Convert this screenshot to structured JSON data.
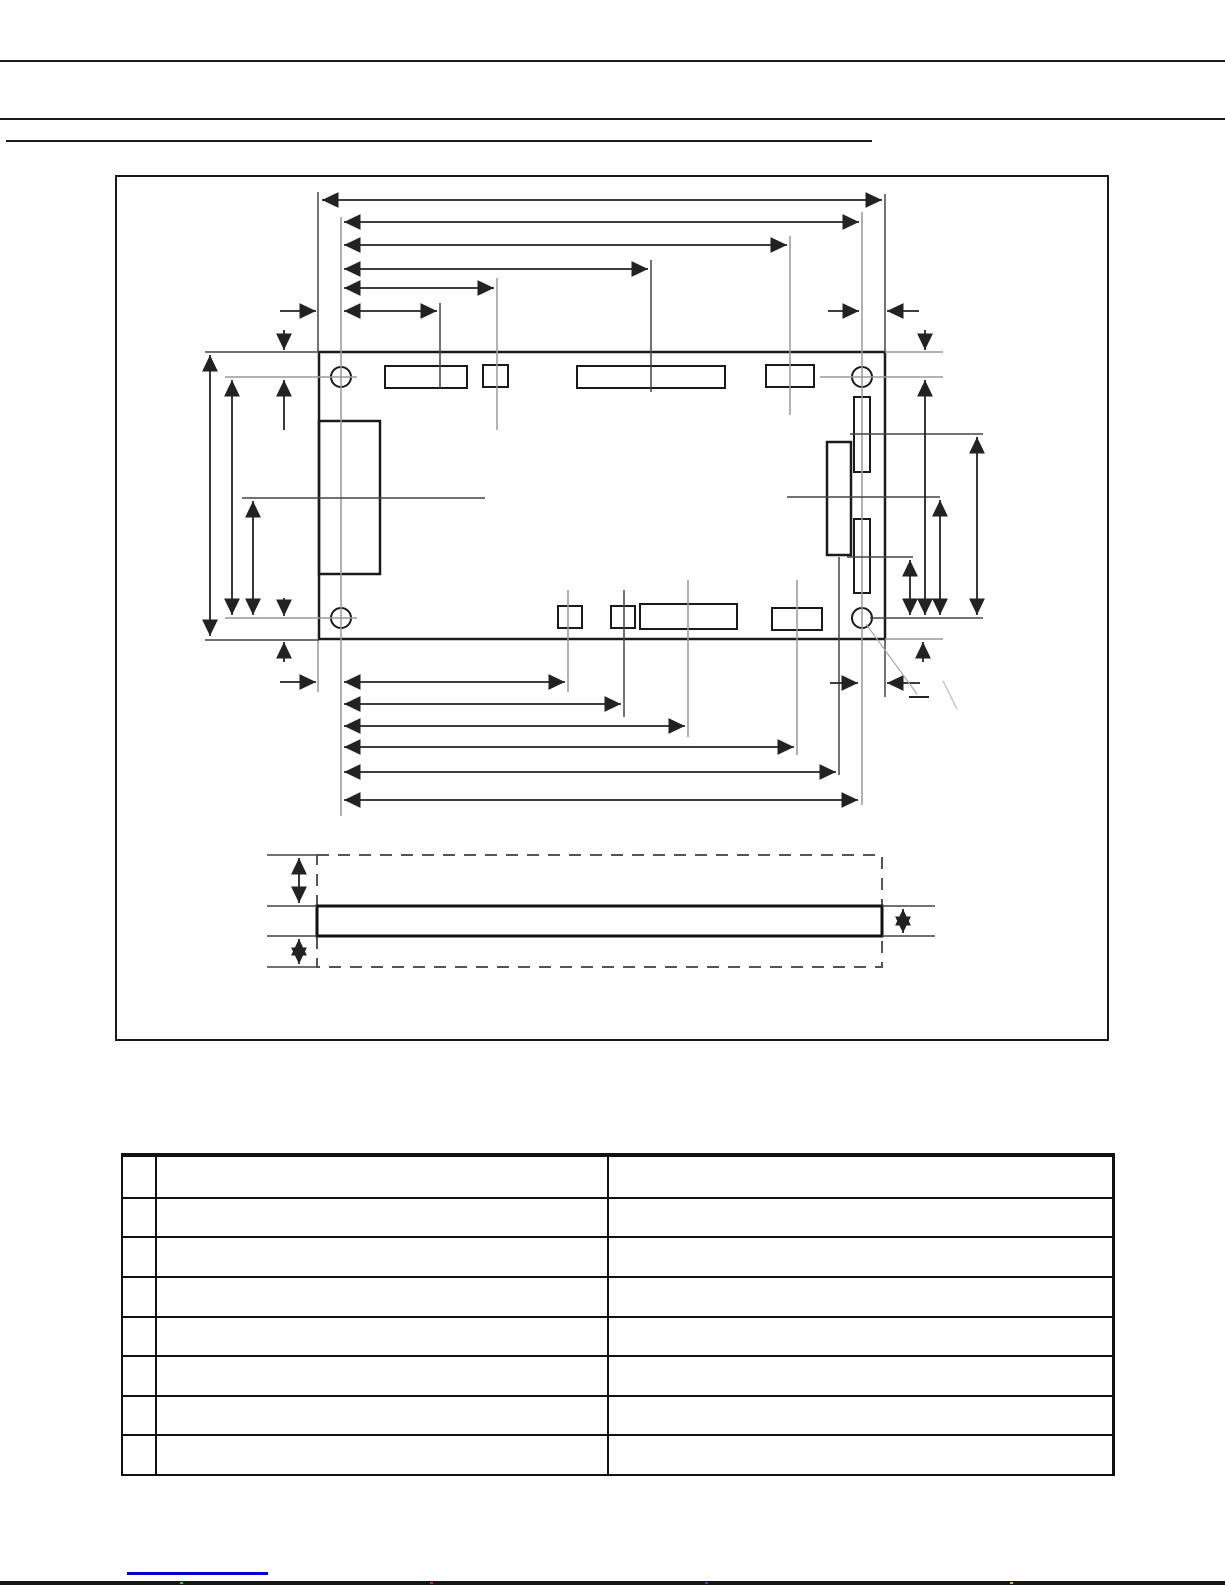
{
  "page": {
    "background": "#ffffff",
    "kind": "datasheet mechanical drawing page (all text redacted / not visible)"
  },
  "header": {
    "rule_color": "#1a1a1a",
    "rules": 3
  },
  "figure": {
    "border_color": "#1a1a1a",
    "parts": {
      "board_outline": "pcb-top-view-outline",
      "mounting_holes": 4,
      "top_edge_connectors": 4,
      "bottom_edge_connectors": 4,
      "left_edge_connector": 1,
      "right_edge_connectors": 3,
      "side_view": "board-thickness-envelope"
    },
    "line_colors": {
      "solid": "#1a1a1a",
      "dimension": "#222222",
      "extension": "#444444",
      "centerline": "#999999",
      "dashed_envelope": "#555555"
    }
  },
  "table": {
    "columns": [
      "",
      "",
      ""
    ],
    "rows": [
      [
        "",
        "",
        ""
      ],
      [
        "",
        "",
        ""
      ],
      [
        "",
        "",
        ""
      ],
      [
        "",
        "",
        ""
      ],
      [
        "",
        "",
        ""
      ],
      [
        "",
        "",
        ""
      ],
      [
        "",
        "",
        ""
      ],
      [
        "",
        "",
        ""
      ]
    ]
  },
  "footer": {
    "link_text": "",
    "link_underline_color": "#0000cc"
  }
}
